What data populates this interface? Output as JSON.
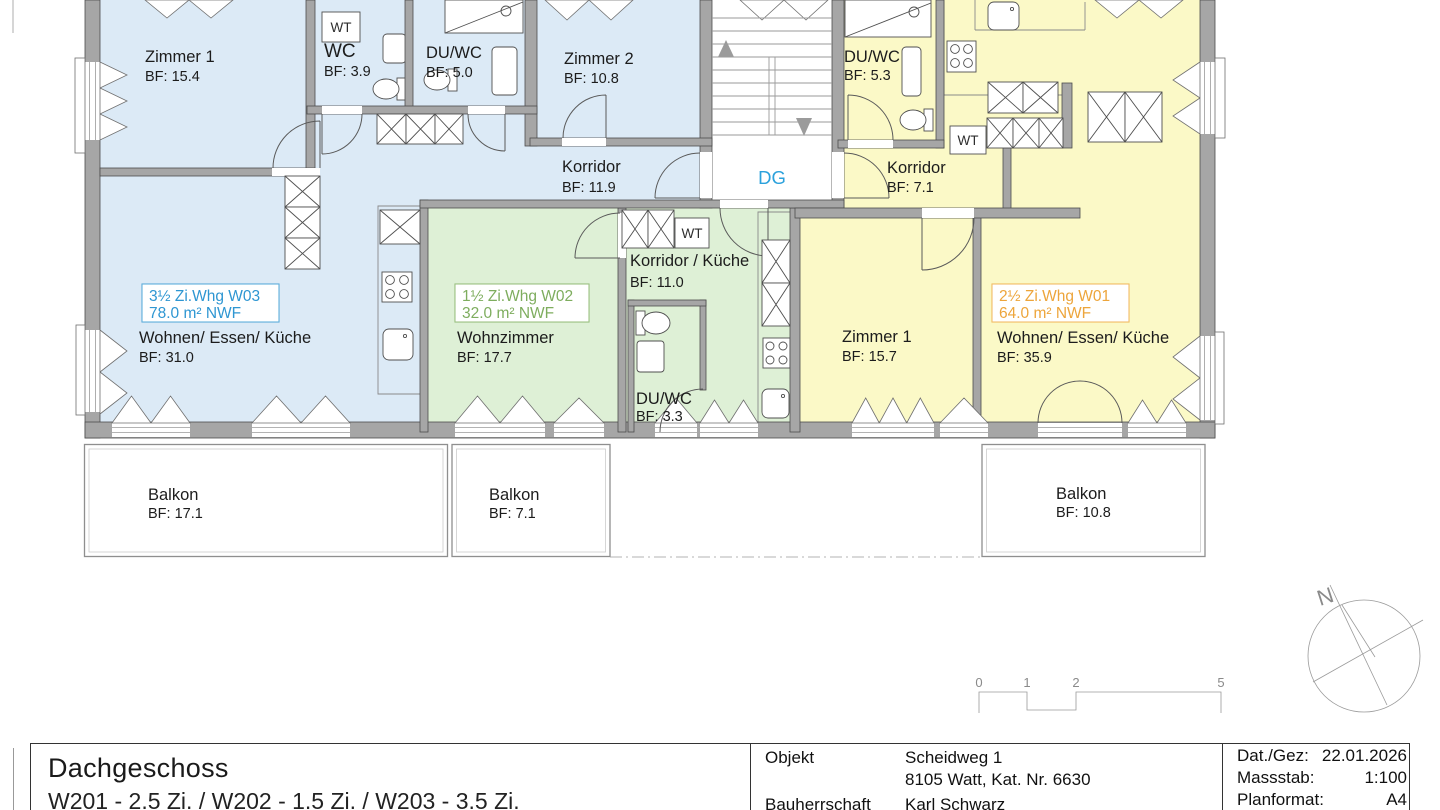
{
  "plan": {
    "wall_color": "#a6a6a6",
    "apartments": {
      "w03": {
        "label_line1": "3½ Zi.Whg  W03",
        "label_line2": "78.0 m² NWF",
        "color": "#2e96d2",
        "fill": "#dceaf6"
      },
      "w02": {
        "label_line1": "1½ Zi.Whg  W02",
        "label_line2": "32.0 m² NWF",
        "color": "#7ead5e",
        "fill": "#def0d6"
      },
      "w01": {
        "label_line1": "2½ Zi.Whg  W01",
        "label_line2": "64.0 m² NWF",
        "color": "#eda53b",
        "fill": "#fbf9c7"
      }
    },
    "rooms": {
      "w03_zimmer1": {
        "name": "Zimmer 1",
        "bf": "BF: 15.4"
      },
      "w03_wc": {
        "name": "WC",
        "bf": "BF: 3.9"
      },
      "w03_duwc": {
        "name": "DU/WC",
        "bf": "BF: 5.0"
      },
      "w03_zimmer2": {
        "name": "Zimmer 2",
        "bf": "BF: 10.8"
      },
      "w03_korridor": {
        "name": "Korridor",
        "bf": "BF: 11.9"
      },
      "w03_wohnen": {
        "name": "Wohnen/ Essen/ Küche",
        "bf": "BF: 31.0"
      },
      "w02_wohnzimmer": {
        "name": "Wohnzimmer",
        "bf": "BF: 17.7"
      },
      "w02_korridor": {
        "name": "Korridor / Küche",
        "bf": "BF: 11.0"
      },
      "w02_duwc": {
        "name": "DU/WC",
        "bf": "BF: 3.3"
      },
      "w01_duwc": {
        "name": "DU/WC",
        "bf": "BF: 5.3"
      },
      "w01_korridor": {
        "name": "Korridor",
        "bf": "BF: 7.1"
      },
      "w01_zimmer1": {
        "name": "Zimmer 1",
        "bf": "BF: 15.7"
      },
      "w01_wohnen": {
        "name": "Wohnen/ Essen/ Küche",
        "bf": "BF: 35.9"
      },
      "balkon_w03": {
        "name": "Balkon",
        "bf": "BF: 17.1"
      },
      "balkon_w02": {
        "name": "Balkon",
        "bf": "BF: 7.1"
      },
      "balkon_w01": {
        "name": "Balkon",
        "bf": "BF: 10.8"
      }
    },
    "stairwell": {
      "label": "DG",
      "label_color": "#2ba1dc"
    },
    "fixtures": {
      "wt_label": "WT"
    },
    "compass": {
      "north_label": "N"
    },
    "scale_bar": {
      "ticks": [
        "0",
        "1",
        "2",
        "5"
      ]
    }
  },
  "title_block": {
    "floor_title": "Dachgeschoss",
    "floor_subtitle": "W201 - 2.5 Zi.  / W202 - 1.5 Zi.  / W203 - 3.5 Zi.",
    "objekt_label": "Objekt",
    "objekt_line1": "Scheidweg 1",
    "objekt_line2": "8105 Watt, Kat. Nr. 6630",
    "bauherrschaft_label": "Bauherrschaft",
    "bauherrschaft_value": "Karl Schwarz",
    "date_label": "Dat./Gez:",
    "date_value": "22.01.2026",
    "scale_label": "Massstab:",
    "scale_value": "1:100",
    "format_label": "Planformat:",
    "format_value": "A4"
  }
}
